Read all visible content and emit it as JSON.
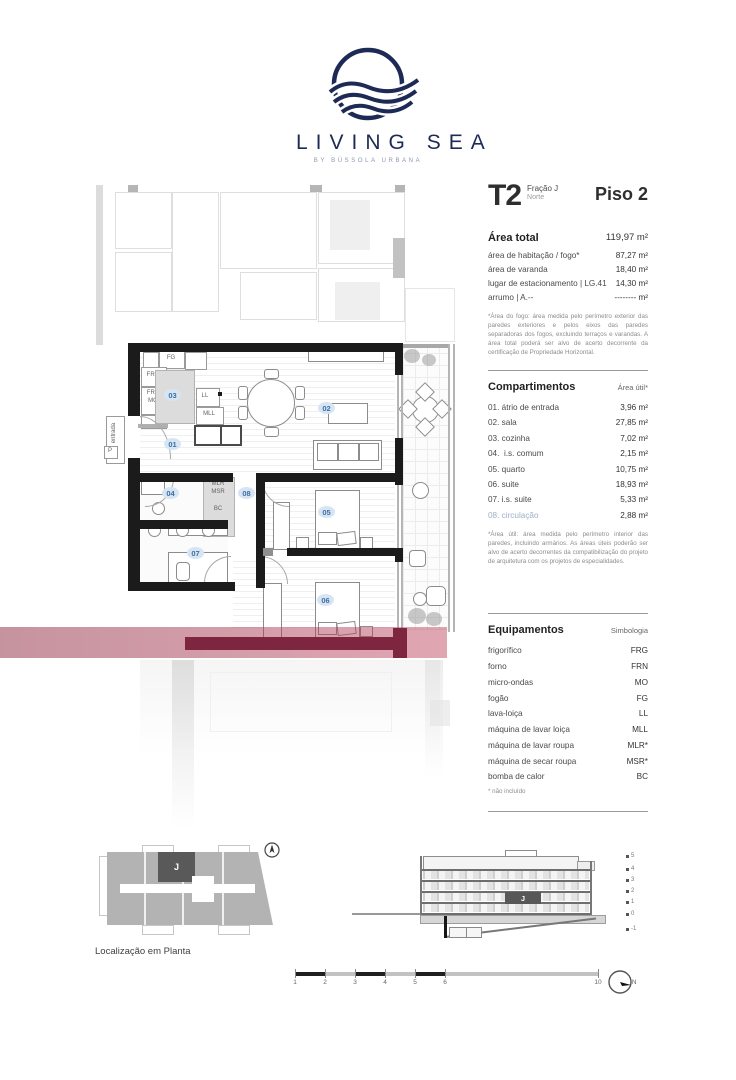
{
  "logo": {
    "title": "LIVING SEA",
    "subtitle": "BY BÚSSOLA URBANA"
  },
  "header": {
    "typology": "T2",
    "fraction": "Fração J",
    "orientation": "Norte",
    "floor": "Piso 2"
  },
  "areas": {
    "total_label": "Área total",
    "total_value": "119,97 m²",
    "rows": [
      {
        "label": "área de habitação / fogo*",
        "value": "87,27 m²"
      },
      {
        "label": "área de varanda",
        "value": "18,40 m²"
      },
      {
        "label": "lugar de estacionamento | LG.41",
        "value": "14,30 m²"
      },
      {
        "label": "arrumo | A.--",
        "value": "-------- m²"
      }
    ],
    "footnote": "*Área do fogo: área medida pelo perímetro exterior das paredes exteriores e pelos eixos das paredes separadoras dos fogos, excluindo terraços e varandas. A área total poderá ser alvo de acerto decorrente da certificação de Propriedade Horizontal."
  },
  "compartments": {
    "title": "Compartimentos",
    "column_header": "Área útil*",
    "rows": [
      {
        "num": "01.",
        "name": "átrio de entrada",
        "value": "3,96 m²"
      },
      {
        "num": "02.",
        "name": "sala",
        "value": "27,85 m²"
      },
      {
        "num": "03.",
        "name": "cozinha",
        "value": "7,02 m²"
      },
      {
        "num": "04.",
        "name": "i.s. comum",
        "value": "2,15 m²"
      },
      {
        "num": "05.",
        "name": "quarto",
        "value": "10,75 m²"
      },
      {
        "num": "06.",
        "name": "suite",
        "value": "18,93 m²"
      },
      {
        "num": "07.",
        "name": "i.s. suite",
        "value": "5,33 m²"
      },
      {
        "num": "08.",
        "name": "circulação",
        "value": "2,88 m²"
      }
    ],
    "footnote": "*Área útil: área medida pelo perímetro interior das paredes, incluindo armários. As áreas úteis poderão ser alvo de acerto decorrentes da compatibilização do projeto de arquitetura com os projetos de especialidades."
  },
  "equipment": {
    "title": "Equipamentos",
    "column_header": "Simbologia",
    "rows": [
      {
        "name": "frigorífico",
        "symbol": "FRG"
      },
      {
        "name": "forno",
        "symbol": "FRN"
      },
      {
        "name": "micro-ondas",
        "symbol": "MO"
      },
      {
        "name": "fogão",
        "symbol": "FG"
      },
      {
        "name": "lava-loiça",
        "symbol": "LL"
      },
      {
        "name": "máquina de lavar loiça",
        "symbol": "MLL"
      },
      {
        "name": "máquina de lavar roupa",
        "symbol": "MLR*"
      },
      {
        "name": "máquina de secar roupa",
        "symbol": "MSR*"
      },
      {
        "name": "bomba de calor",
        "symbol": "BC"
      }
    ],
    "footnote": "* não incluído"
  },
  "plan": {
    "rooms": {
      "r01": "01",
      "r02": "02",
      "r03": "03",
      "r04": "04",
      "r05": "05",
      "r06": "06",
      "r07": "07",
      "r08": "08"
    },
    "labels": {
      "fg": "FG",
      "frg": "FRG",
      "frn": "FRN",
      "mo": "MO",
      "ll": "LL",
      "mll": "MLL",
      "mlr": "MLR",
      "msr": "MSR",
      "bc": "BC",
      "entrada": "entrada",
      "p": "P"
    }
  },
  "site_plan": {
    "caption": "Localização em Planta",
    "unit": "J"
  },
  "elevation": {
    "unit": "J",
    "levels": [
      "5",
      "4",
      "3",
      "2",
      "1",
      "0",
      "-1"
    ]
  },
  "scale_bar": {
    "ticks": [
      "1",
      "2",
      "3",
      "4",
      "5",
      "6",
      "10"
    ],
    "north": "N"
  },
  "colors": {
    "navy": "#1e2a56",
    "highlight_red": "#a03a55",
    "highlight_maroon": "#7e2640",
    "room_label_blue": "#3c6fa5"
  }
}
